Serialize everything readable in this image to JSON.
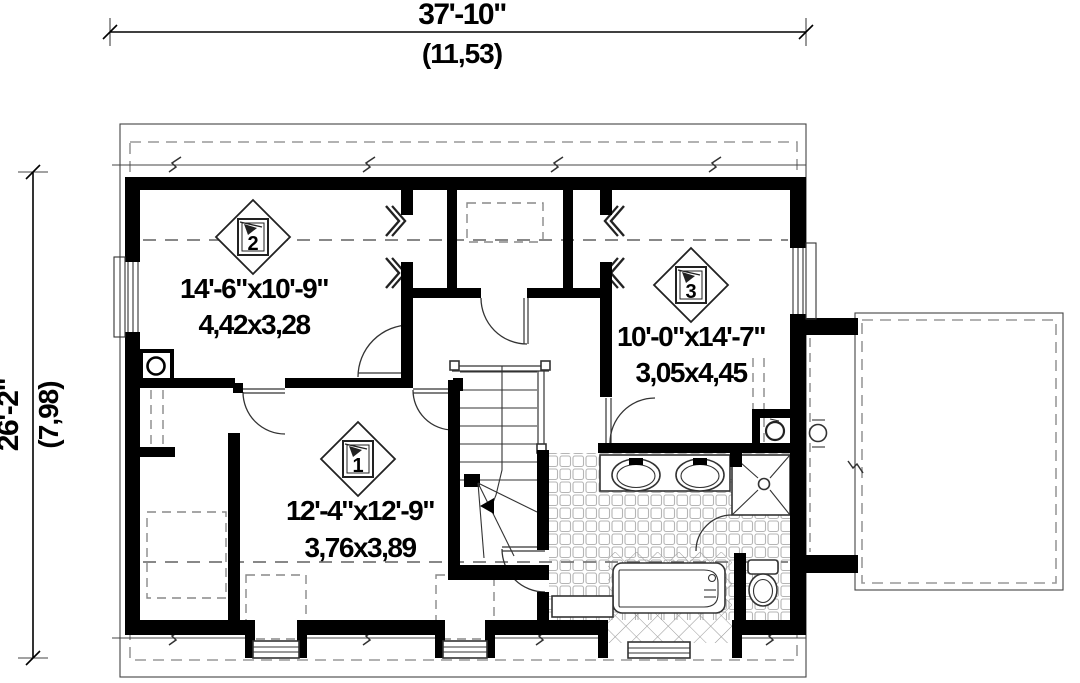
{
  "dimensions": {
    "top": {
      "imperial": "37'-10\"",
      "metric": "(11,53)"
    },
    "left": {
      "imperial": "26'-2\"",
      "metric": "(7,98)"
    }
  },
  "rooms": {
    "bedroom2": {
      "marker": "2",
      "imperial": "14'-6\"x10'-9\"",
      "metric": "4,42x3,28"
    },
    "bedroom3": {
      "marker": "3",
      "imperial": "10'-0\"x14'-7\"",
      "metric": "3,05x4,45"
    },
    "bedroom1": {
      "marker": "1",
      "imperial": "12'-4\"x12'-9\"",
      "metric": "3,76x3,89"
    }
  },
  "colors": {
    "wall": "#000000",
    "line": "#333333",
    "dashed": "#999999",
    "tile": "#aaaaaa",
    "background": "#ffffff"
  }
}
